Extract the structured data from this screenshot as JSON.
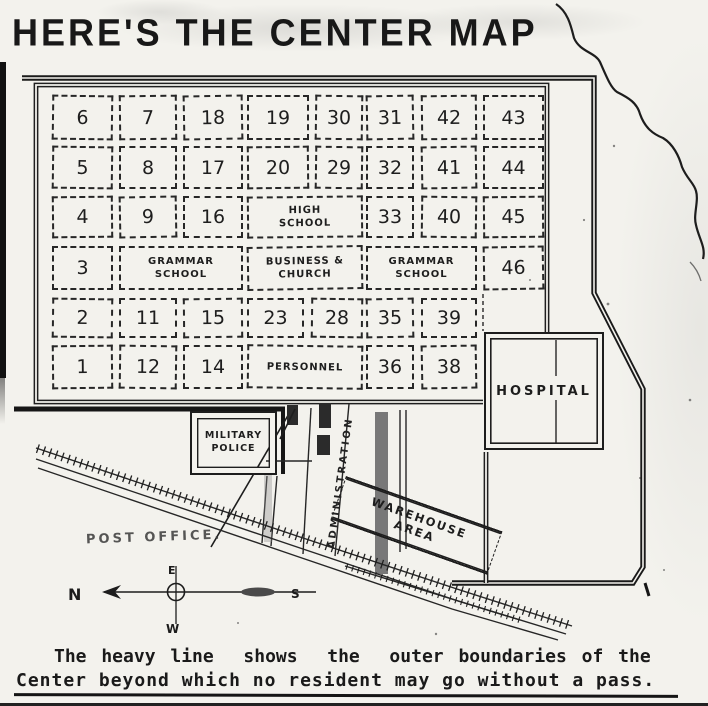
{
  "title": "HERE'S THE CENTER MAP",
  "map": {
    "numbered_blocks": [
      "6",
      "7",
      "18",
      "19",
      "30",
      "31",
      "42",
      "43",
      "5",
      "8",
      "17",
      "20",
      "29",
      "32",
      "41",
      "44",
      "4",
      "9",
      "16",
      "33",
      "40",
      "45",
      "3",
      "46",
      "2",
      "11",
      "15",
      "23",
      "28",
      "35",
      "39",
      "1",
      "12",
      "14",
      "36",
      "38"
    ],
    "building_blocks": [
      {
        "key": "high_school",
        "lines": [
          "HIGH",
          "SCHOOL"
        ]
      },
      {
        "key": "grammar_school_west",
        "lines": [
          "GRAMMAR",
          "SCHOOL"
        ]
      },
      {
        "key": "business_church",
        "lines": [
          "BUSINESS &",
          "CHURCH"
        ]
      },
      {
        "key": "grammar_school_east",
        "lines": [
          "GRAMMAR",
          "SCHOOL"
        ]
      },
      {
        "key": "personnel",
        "lines": [
          "PERSONNEL"
        ]
      }
    ],
    "areas": {
      "hospital": "HOSPITAL",
      "military_police": [
        "MILITARY",
        "POLICE"
      ],
      "administration": "ADMINISTRATION",
      "warehouse": [
        "WAREHOUSE",
        "AREA"
      ],
      "post_office": "POST OFFICE."
    },
    "compass": {
      "north": "N",
      "east": "E",
      "south": "S",
      "west": "W"
    }
  },
  "caption": {
    "line1": "The heavy line  shows  the  outer boundaries of the",
    "line2": "Center beyond which no resident may go without a pass."
  },
  "colors": {
    "ink": "#1d1d1d",
    "paper": "#f3f2ed"
  }
}
